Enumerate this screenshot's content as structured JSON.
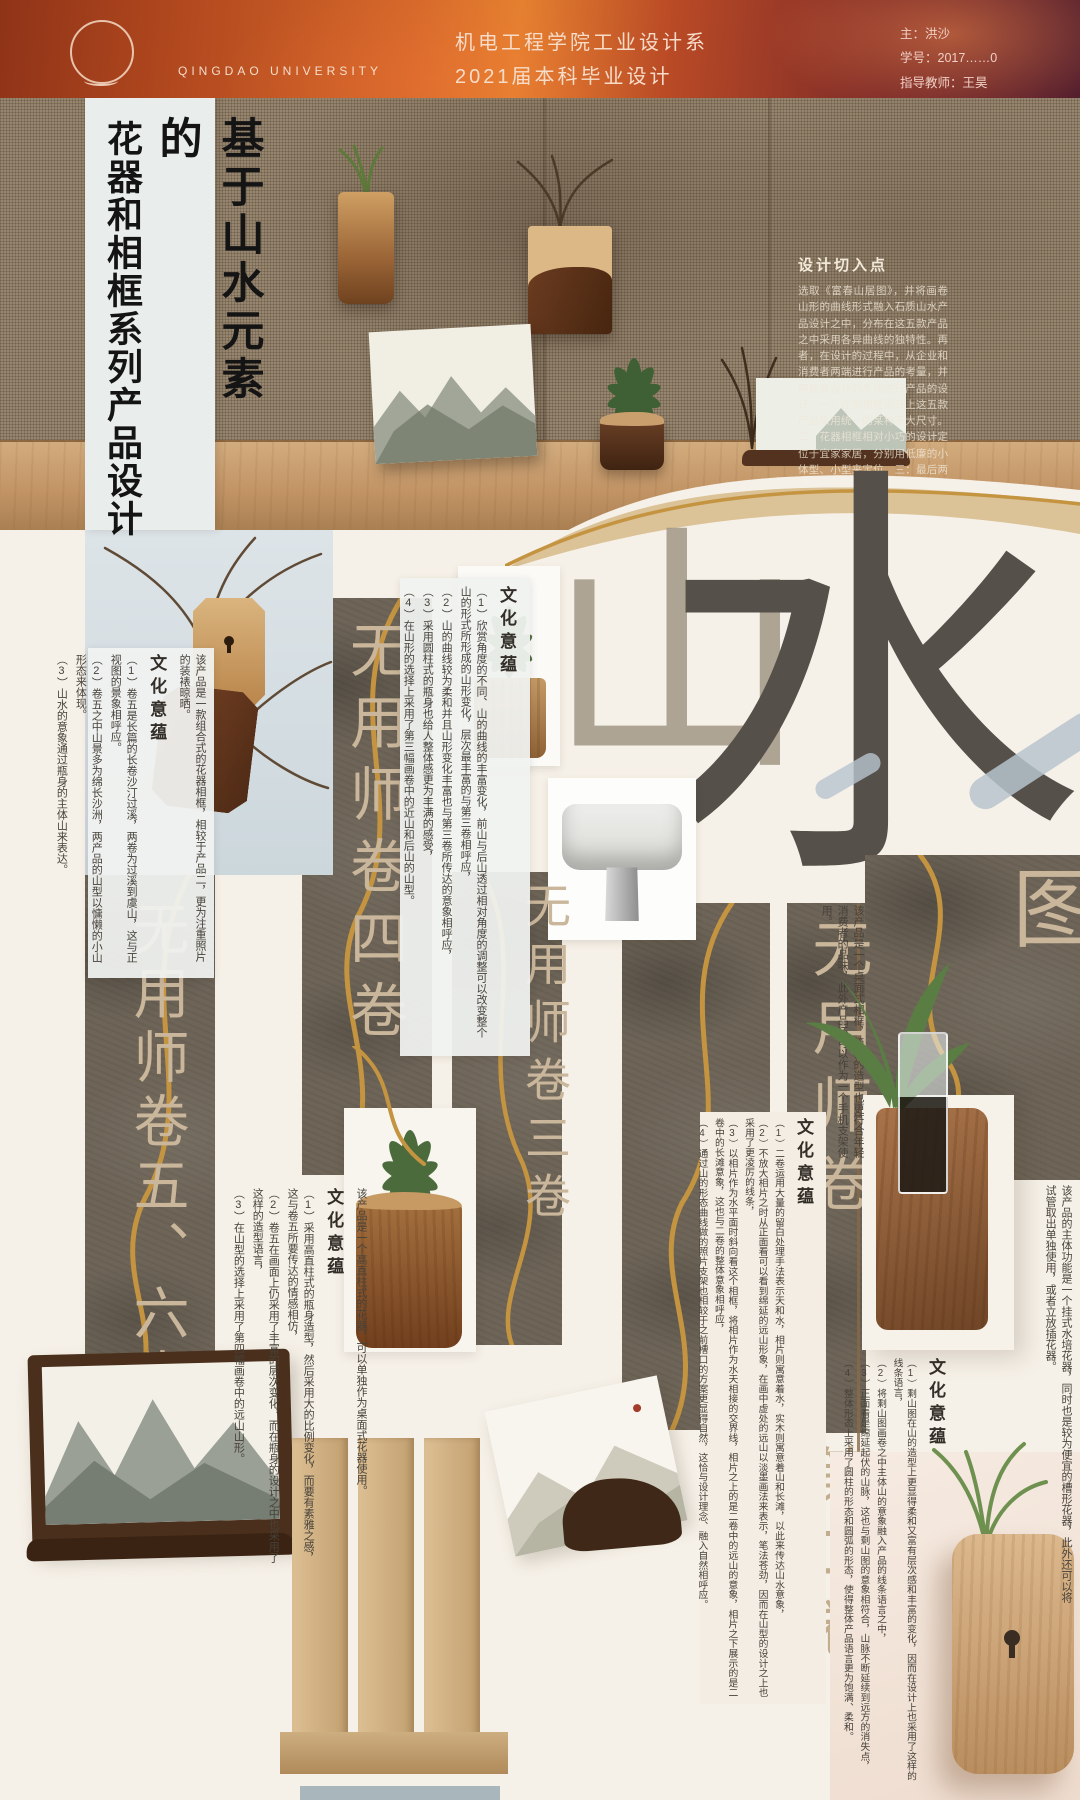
{
  "header": {
    "logo_text": "QINGDAO UNIVERSITY",
    "department": "机电工程学院工业设计系",
    "project": "2021届本科毕业设计",
    "author": "主：洪沙",
    "student_id": "学号：2017……0",
    "advisor": "指导教师：王昊"
  },
  "poster_title": {
    "line1": "基于山水元素的",
    "line2": "花器和相框系列产品设计"
  },
  "design_entry": {
    "title": "设计切入点",
    "body": "选取《富春山居图》，并将画卷山形的曲线形式融入石质山水产品设计之中，分布在这五款产品之中采用各异曲线的独特性。再者，在设计的过程中，从企业和消费者两端进行产品的考量，并用铭意设计的手法进行产品的设计。一：在实用性设计上这五款产品采用统一的某种不大尺寸。二：花器相框相对小巧的设计定位于宜家家居，分别用低廉的小体型、小型来定位。三：最后两款相框要与花器的组合产品以其中一季分山水意象设计一款功能和与组合形式。"
  },
  "big_chars": {
    "shan": "山",
    "shui": "水"
  },
  "scrolls": {
    "s56": "无用师卷五、六卷",
    "s4": "无用师卷四卷",
    "s3": "无用师卷三卷",
    "s2a": "无用师卷",
    "s2b": "第二卷",
    "s1": "剩山图"
  },
  "culture_title": "文化意蕴",
  "b1": {
    "intro": "该产品是一款组合式的花器相框，相较于产品二，更为注重照片的装裱晾晒。",
    "p1": "（1）卷五是长篇的长卷沙汀过溪，两卷为过溪到虞山，这与正视图的景象相呼应。",
    "p2": "（2）卷五之中山景多为绵长沙洲，两产品的山型以慵懒的小山形态来体现。",
    "p3": "（3）山水的意象通过瓶身的主体山来表达。"
  },
  "b2": {
    "p1": "（1）欣赏角度的不同、山的曲线的丰富变化，前山与后山透过相对角度的调整可以改变整个山的形式所形成的山形变化，层次最丰富的与第三卷相呼应，",
    "p2": "（2）山的曲线较为柔和并且山形变化丰富也与第三卷所传达的意象相呼应，",
    "p3": "（3）采用圆柱式的瓶身也给人整体感更为丰满的感受，",
    "p4": "（4）在山形的选择上采用了第三幅画卷中的近山和后山的山型。"
  },
  "b3": {
    "intro": "该产品是一个桌面式相框，简易的造型也更符合年轻消费者的品味，此外产品还可以作为一个手机支架使用。"
  },
  "b4": {
    "p1": "（1）二卷运用大量的留白处理手法表示天和水，相片则寓意着水，实木则寓意着山和长滩，以此来传达山水意象，",
    "p2": "（2）不放大相片之时从正面看可以看到绵延的远山形象，在画中虚处的远山以淡墨画法来表示，笔法苍劲，因而在山型的设计之上也采用了更凌厉的线条，",
    "p3": "（3）以相片作为水平面时斜向看这个相框，将相片作为水天相接的交界线，相片之上的是二卷中的远山的意象，相片之下展示的是二卷中的长滩意象，这也与二卷的整体意象相呼应，",
    "p4": "（4）通过山的形态曲线做的照片支架也相较于之前槽口的方案更显得自然，这恰与设计理念、融入自然相呼应。"
  },
  "b5": {
    "intro": "该产品是一个高直柱式的花器，可以单独作为桌面式花器使用。",
    "p1": "（1）采用高直柱式的瓶身造型，然后采用大的比例变化，而要有素雅之感，这与卷五所要传达的情感相仿，",
    "p2": "（2）卷五在画面上仍采用了丰富的层次变化，而在瓶身的设计之中也采用了这样的造型语言，",
    "p3": "（3）在山型的选择上采用了第四幅画卷中的远山山形。"
  },
  "b6": {
    "intro": "该产品的主体功能是一个挂式水培花器，同时也是较为便宜的槽形花器，此外还可以将试管取出单独使用，或者立放插花器。",
    "p1": "（1）剩山图在山的造型上更显得柔和又富有层次感和丰富的变化，因而在设计上也采用了这样的线条语言，",
    "p2": "（2）将剩山图画卷之中主体山的意象融入产品的线条语言之中，",
    "p3": "（3）正面看是绵延起伏的山脉，这也与剩山图的意象相符合，山脉不断延续到远方的消失点，",
    "p4": "（4）整体形态上采用了圆柱的形态和圆弧的形态，使得整体产品语言更为饱满、柔和。"
  },
  "colors": {
    "gold": "#c49440",
    "panel_stone": "#6e6558",
    "header_orange": "#d4682a",
    "cream": "#f6f1e8",
    "brush_beige": "#c9b69b"
  }
}
